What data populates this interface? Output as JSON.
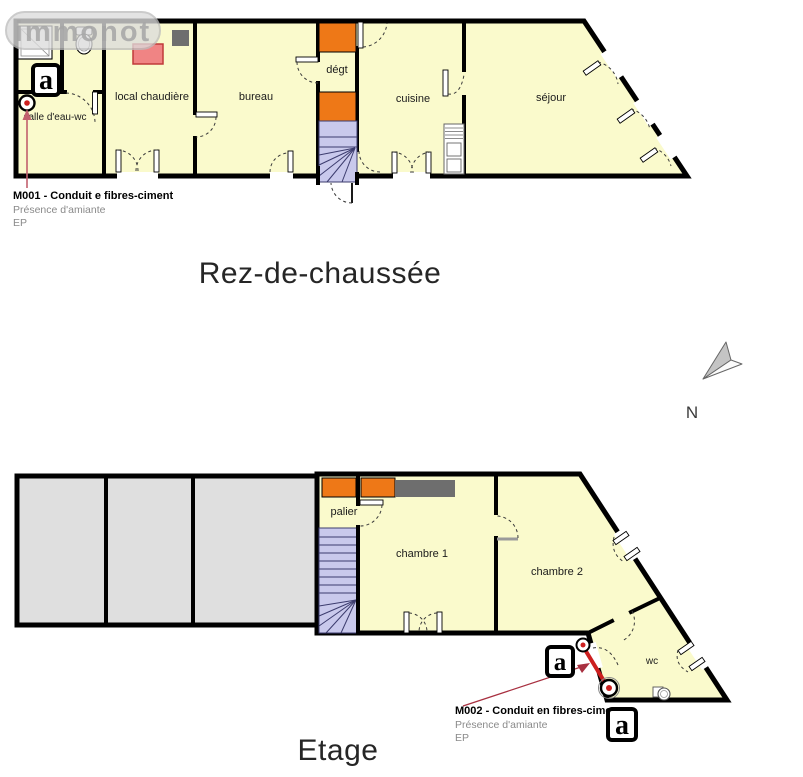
{
  "watermark": {
    "text": "immonot"
  },
  "compass": {
    "label": "N"
  },
  "colors": {
    "room_fill": "#FAFACC",
    "attic_fill": "#DFDFDF",
    "stair_fill": "#C9C9EC",
    "orange": "#EE7817",
    "conduit_gray": "#6E6E6E",
    "boiler_pink": "#F08484",
    "asbestos_red": "#CC1F1F"
  },
  "ground_floor": {
    "title": "Rez-de-chaussée",
    "rooms": {
      "bathroom": "salle d'eau-wc",
      "boiler_room": "local chaudière",
      "office": "bureau",
      "hallway": "dégt",
      "kitchen": "cuisine",
      "living_room": "séjour"
    },
    "asbestos_marker": "a",
    "annotation": {
      "title": "M001 - Conduit e fibres-ciment",
      "subtitle": "Présence d'amiante",
      "code": "EP"
    }
  },
  "upper_floor": {
    "title": "Etage",
    "rooms": {
      "landing": "palier",
      "bedroom1": "chambre 1",
      "bedroom2": "chambre 2",
      "wc": "wc"
    },
    "asbestos_marker": "a",
    "annotation": {
      "title": "M002 - Conduit en fibres-cimen",
      "subtitle": "Présence d'amiante",
      "code": "EP"
    }
  }
}
